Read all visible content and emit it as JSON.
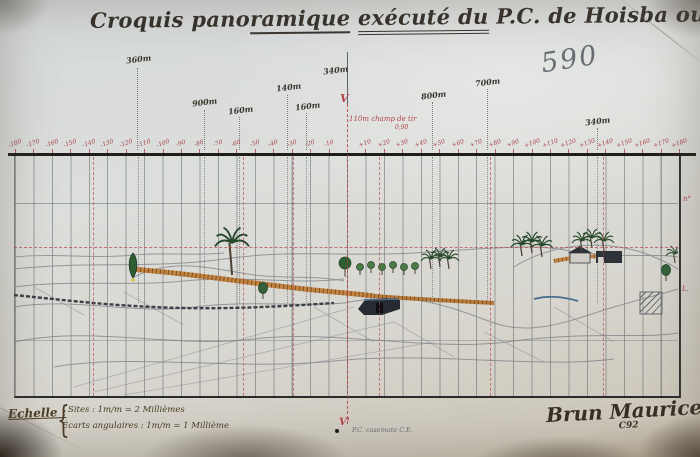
{
  "title": {
    "parts": [
      {
        "t": "Croquis pano",
        "u": 0
      },
      {
        "t": "ramique",
        "u": 1
      },
      {
        "t": " ",
        "u": 0
      },
      {
        "t": "exécuté du",
        "u": 2
      },
      {
        "t": " P.C. de Hoisba ouest",
        "u": 0
      }
    ]
  },
  "pencil_note": "590",
  "range_labels": [
    {
      "text": "360m",
      "x": 126,
      "y": 54,
      "lx": 137,
      "l1": 68
    },
    {
      "text": "900m",
      "x": 192,
      "y": 97,
      "lx": 204,
      "l1": 110
    },
    {
      "text": "160m",
      "x": 228,
      "y": 105,
      "lx": 239,
      "l1": 117
    },
    {
      "text": "140m",
      "x": 276,
      "y": 82,
      "lx": 287,
      "l1": 95
    },
    {
      "text": "160m",
      "x": 295,
      "y": 101,
      "lx": 306,
      "l1": 113
    },
    {
      "text": "340m",
      "x": 323,
      "y": 65
    },
    {
      "text": "800m",
      "x": 421,
      "y": 90,
      "lx": 432,
      "l1": 102
    },
    {
      "text": "700m",
      "x": 475,
      "y": 77,
      "lx": 487,
      "l1": 89
    },
    {
      "text": "340m",
      "x": 585,
      "y": 116,
      "lx": 597,
      "l1": 128
    }
  ],
  "axis": {
    "v": "V",
    "v_prime": "V'"
  },
  "field_note": {
    "text": "110m champ de tir",
    "sub": "0,90"
  },
  "ruler": {
    "min": -180,
    "max": 180,
    "step": 10,
    "center_x": 347,
    "px_per_step": 18.45,
    "num_y": 140,
    "line_end": 150
  },
  "grid": {
    "red_x": [
      93,
      243,
      293,
      379,
      490,
      603
    ],
    "dotted_x": [
      138,
      204,
      239,
      287,
      306,
      432,
      487,
      597
    ]
  },
  "scene_features": [
    {
      "type": "cypress",
      "x": 119,
      "y": 108
    },
    {
      "type": "palm",
      "x": 218,
      "y": 86,
      "s": 1.7,
      "t": 32
    },
    {
      "type": "bush",
      "x": 249,
      "y": 131
    },
    {
      "type": "round-tree",
      "x": 331,
      "y": 106,
      "s": 1.7
    },
    {
      "type": "round-tree",
      "x": 346,
      "y": 110,
      "s": 1
    },
    {
      "type": "round-tree",
      "x": 357,
      "y": 108,
      "s": 1
    },
    {
      "type": "round-tree",
      "x": 368,
      "y": 110,
      "s": 1
    },
    {
      "type": "round-tree",
      "x": 379,
      "y": 108,
      "s": 1
    },
    {
      "type": "round-tree",
      "x": 390,
      "y": 110,
      "s": 1
    },
    {
      "type": "round-tree",
      "x": 401,
      "y": 109,
      "s": 1
    },
    {
      "type": "palm",
      "x": 417,
      "y": 102,
      "s": 1
    },
    {
      "type": "palm",
      "x": 426,
      "y": 100,
      "s": 1
    },
    {
      "type": "palm",
      "x": 435,
      "y": 102,
      "s": 1
    },
    {
      "type": "palm",
      "x": 508,
      "y": 88,
      "s": 1.1
    },
    {
      "type": "palm",
      "x": 518,
      "y": 85,
      "s": 1.1
    },
    {
      "type": "palm",
      "x": 528,
      "y": 89,
      "s": 1.1
    },
    {
      "type": "palm",
      "x": 568,
      "y": 84,
      "s": 1
    },
    {
      "type": "palm",
      "x": 578,
      "y": 81,
      "s": 1
    },
    {
      "type": "palm",
      "x": 590,
      "y": 84,
      "s": 1
    },
    {
      "type": "palm",
      "x": 661,
      "y": 97,
      "s": 0.9
    },
    {
      "type": "bush",
      "x": 652,
      "y": 113
    }
  ],
  "margin_marks": [
    {
      "text": "n°",
      "x": 683,
      "y": 195
    },
    {
      "text": "L.",
      "x": 682,
      "y": 285
    }
  ],
  "scale_block": {
    "heading": "Echelle :",
    "brace": "{",
    "line1": "Sites : 1m/m = 2 Millièmes",
    "line2": "Écarts angulaires : 1m/m = 1 Millième"
  },
  "bottom_note": "P.C. casemate C.E.",
  "signature": {
    "name": "Brun Maurice",
    "rank": "Brigadier",
    "unit": "C92"
  },
  "colors": {
    "paper": "#d8dad6",
    "ink": "#35302a",
    "red": "#b2424b",
    "pencil": "#7a8086",
    "tree_green": "#2f5e33",
    "light_green": "#4c7a45",
    "road_orange": "#bf7a33",
    "road_hatch": "#6e4217",
    "dark_structure": "#262b31",
    "stream_blue": "#4a6e8e",
    "trunk": "#4c4336",
    "base_dot_yellow": "#d6c44e"
  }
}
